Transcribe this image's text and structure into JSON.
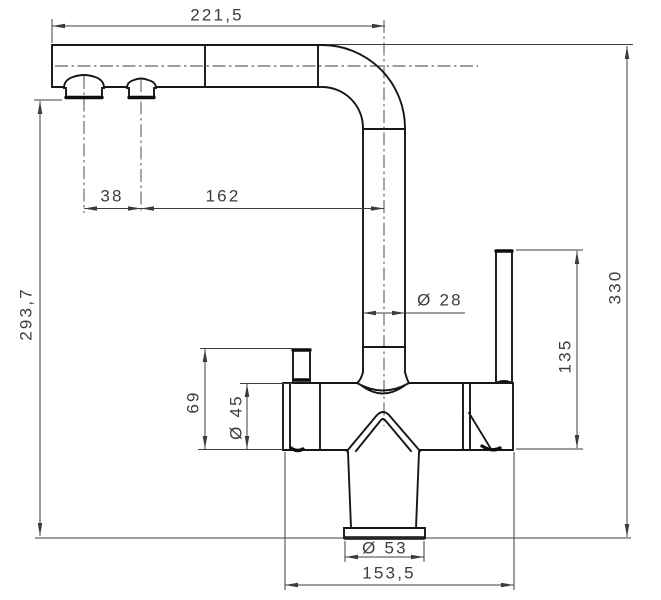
{
  "style": {
    "paper_color": "#ffffff",
    "object_line_color": "#161616",
    "dimension_line_color": "#3c3c3c"
  },
  "labels": {
    "spout_reach": "221,5",
    "outlet_spacing": "38",
    "outlet_to_riser": "162",
    "riser_diameter": "Ø 28",
    "spout_height": "293,7",
    "overall_height": "330",
    "lever_height": "135",
    "side_outlet_height": "69",
    "body_diameter": "Ø 45",
    "base_diameter": "Ø 53",
    "base_length": "153,5"
  }
}
